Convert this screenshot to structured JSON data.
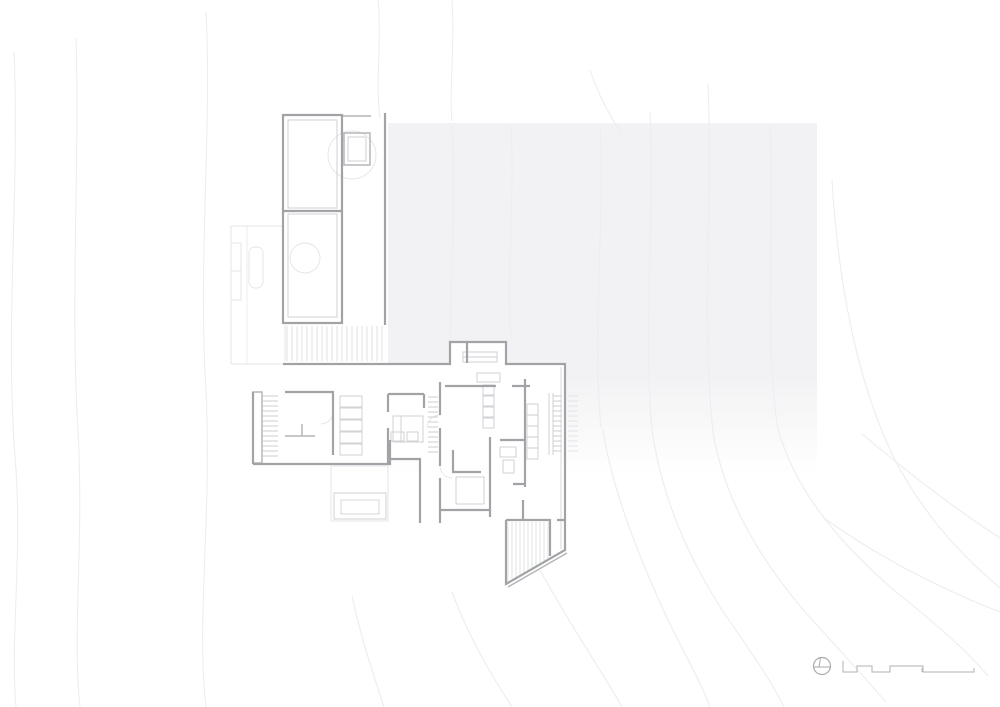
{
  "meta": {
    "canvas_width": 1000,
    "canvas_height": 707
  },
  "palette": {
    "background": "#ffffff",
    "wall": "#a2a3a6",
    "wall_light": "#b5b6b9",
    "detail": "#cdced1",
    "hatch": "#d8d9db",
    "faint": "#e3e4e7",
    "contour": "#ecedf0",
    "roof_shade": "#f2f2f4",
    "symbol": "#a8a9ab"
  },
  "symbols": {
    "north_arrow_icon": "circle with meridian chord",
    "scale_bar_icon": "stepped graphic scale"
  },
  "drawing": {
    "layers": [
      {
        "name": "roof-shade",
        "stroke": "none",
        "width": 0,
        "elements": [
          {
            "t": "rect",
            "x": 388,
            "y": 123,
            "w": 429,
            "h": 352,
            "fill": "url(#shadeGrad)",
            "sw": 0
          }
        ]
      },
      {
        "name": "contours",
        "stroke": "#ecedf0",
        "width": 1.1,
        "elements": [
          {
            "t": "path",
            "d": "M14 52 C20 190 4 330 16 470 C22 560 10 640 16 707"
          },
          {
            "t": "path",
            "d": "M76 38 C80 160 70 300 78 430 C84 550 72 630 80 707"
          },
          {
            "t": "path",
            "d": "M206 12 C212 130 198 260 206 390 C212 520 196 620 206 707"
          },
          {
            "t": "path",
            "d": "M378 0 C382 42 375 84 380 118"
          },
          {
            "t": "path",
            "d": "M452 0 C455 45 449 88 452 121"
          },
          {
            "t": "path",
            "d": "M590 70 C600 100 612 118 621 133"
          },
          {
            "t": "path",
            "d": "M452 126 C457 230 446 330 452 428"
          },
          {
            "t": "path",
            "d": "M511 126 C515 200 506 280 511 338"
          },
          {
            "t": "path",
            "d": "M600 126 C605 220 592 330 601 428"
          },
          {
            "t": "path",
            "d": "M603 430 C612 490 640 560 668 620 C685 655 700 680 710 707"
          },
          {
            "t": "path",
            "d": "M650 112 C655 220 643 330 652 430 C662 500 690 560 722 610 C748 648 770 678 784 707"
          },
          {
            "t": "path",
            "d": "M708 84 C713 200 701 320 713 432 C725 505 765 565 805 612 C838 648 865 678 886 702"
          },
          {
            "t": "path",
            "d": "M770 126 C775 230 764 330 777 424 C793 492 845 548 896 592 C934 622 968 652 988 676"
          },
          {
            "t": "path",
            "d": "M832 180 C838 280 856 380 894 458 C926 520 965 558 1000 588"
          },
          {
            "t": "path",
            "d": "M862 434 C912 476 960 512 1000 538"
          },
          {
            "t": "path",
            "d": "M824 518 C874 554 934 586 1000 612"
          },
          {
            "t": "path",
            "d": "M352 596 C362 642 374 676 384 707"
          },
          {
            "t": "path",
            "d": "M452 592 C470 640 492 676 512 707"
          },
          {
            "t": "path",
            "d": "M540 570 C570 625 600 668 622 707"
          }
        ]
      },
      {
        "name": "plan-fill",
        "stroke": "none",
        "width": 0,
        "elements": [
          {
            "t": "path",
            "d": "M283 364 H450 V342 H506 V364 H565 V550 L506 584 V520 H440 V523 H420 V459 H390 V464 H253 V392 H283 Z",
            "fill": "#ffffff",
            "sw": 0
          }
        ]
      },
      {
        "name": "faint",
        "stroke": "#e3e4e7",
        "width": 0.9,
        "elements": [
          {
            "t": "path",
            "d": "M231 364 V226 H283"
          },
          {
            "t": "path",
            "d": "M231 364 H283"
          },
          {
            "t": "path",
            "d": "M247 226 V364",
            "sw": 0.7
          },
          {
            "t": "rect",
            "x": 231,
            "y": 243,
            "w": 10,
            "h": 28
          },
          {
            "t": "rect",
            "x": 231,
            "y": 271,
            "w": 10,
            "h": 29
          },
          {
            "t": "rect",
            "x": 249,
            "y": 247,
            "w": 14,
            "h": 41,
            "rx": 6
          },
          {
            "t": "circle",
            "cx": 352,
            "cy": 155,
            "r": 24
          },
          {
            "t": "circle",
            "cx": 305,
            "cy": 258,
            "r": 15
          },
          {
            "t": "rect",
            "x": 331,
            "y": 466,
            "w": 57,
            "h": 55
          },
          {
            "t": "path",
            "d": "M285 325 V361"
          },
          {
            "t": "hh",
            "x0": 568,
            "x1": 578,
            "y0": 396,
            "y1": 454,
            "step": 5
          },
          {
            "t": "path",
            "d": "M440 415 A13 13 0 0 0 427 428"
          },
          {
            "t": "path",
            "d": "M440 466 A12 12 0 0 0 452 478"
          },
          {
            "t": "path",
            "d": "M333 412 A12 12 0 0 1 321 424"
          }
        ]
      },
      {
        "name": "hatch",
        "stroke": "#d8d9db",
        "width": 0.8,
        "elements": [
          {
            "t": "hv",
            "x0": 287,
            "x1": 382,
            "y0": 326,
            "y1": 361,
            "step": 5
          },
          {
            "t": "path",
            "d": "M508 522 V582.8 M512 522 V580.5 M516 522 V578.2 M520 522 V575.9 M524 522 V573.6 M528 522 V571.3 M532 522 V569 M536 522 V566.7 M540 522 V564.4 M544 522 V562.1 M548 522 V559.8"
          }
        ]
      },
      {
        "name": "detail",
        "stroke": "#cdced1",
        "width": 0.9,
        "elements": [
          {
            "t": "rect",
            "x": 288,
            "y": 120,
            "w": 49,
            "h": 88
          },
          {
            "t": "rect",
            "x": 288,
            "y": 214,
            "w": 49,
            "h": 103
          },
          {
            "t": "rect",
            "x": 348,
            "y": 137,
            "w": 18,
            "h": 24
          },
          {
            "t": "rect",
            "x": 463,
            "y": 352,
            "w": 34,
            "h": 10
          },
          {
            "t": "line",
            "x1": 463,
            "y1": 357,
            "x2": 497,
            "y2": 357
          },
          {
            "t": "path",
            "d": "M549 393 V455 M553 393 V455"
          },
          {
            "t": "rect",
            "x": 340,
            "y": 396,
            "w": 22,
            "h": 11
          },
          {
            "t": "rect",
            "x": 340,
            "y": 408,
            "w": 22,
            "h": 11
          },
          {
            "t": "rect",
            "x": 340,
            "y": 420,
            "w": 22,
            "h": 11
          },
          {
            "t": "rect",
            "x": 340,
            "y": 432,
            "w": 22,
            "h": 11
          },
          {
            "t": "rect",
            "x": 340,
            "y": 444,
            "w": 22,
            "h": 11
          },
          {
            "t": "rect",
            "x": 393,
            "y": 416,
            "w": 30,
            "h": 26
          },
          {
            "t": "line",
            "x1": 401,
            "y1": 416,
            "x2": 401,
            "y2": 442
          },
          {
            "t": "rect",
            "x": 391,
            "y": 432,
            "w": 13,
            "h": 9
          },
          {
            "t": "rect",
            "x": 407,
            "y": 432,
            "w": 11,
            "h": 9
          },
          {
            "t": "rect",
            "x": 483,
            "y": 385,
            "w": 11,
            "h": 10
          },
          {
            "t": "rect",
            "x": 483,
            "y": 396,
            "w": 11,
            "h": 10
          },
          {
            "t": "rect",
            "x": 483,
            "y": 407,
            "w": 11,
            "h": 10
          },
          {
            "t": "rect",
            "x": 483,
            "y": 418,
            "w": 11,
            "h": 10
          },
          {
            "t": "rect",
            "x": 527,
            "y": 404,
            "w": 11,
            "h": 11
          },
          {
            "t": "rect",
            "x": 527,
            "y": 415,
            "w": 11,
            "h": 11
          },
          {
            "t": "rect",
            "x": 527,
            "y": 426,
            "w": 11,
            "h": 11
          },
          {
            "t": "rect",
            "x": 527,
            "y": 437,
            "w": 11,
            "h": 11
          },
          {
            "t": "rect",
            "x": 527,
            "y": 448,
            "w": 11,
            "h": 11
          },
          {
            "t": "rect",
            "x": 456,
            "y": 477,
            "w": 28,
            "h": 27
          },
          {
            "t": "rect",
            "x": 477,
            "y": 373,
            "w": 23,
            "h": 9
          },
          {
            "t": "rect",
            "x": 500,
            "y": 447,
            "w": 16,
            "h": 10
          },
          {
            "t": "rect",
            "x": 503,
            "y": 460,
            "w": 11,
            "h": 13
          },
          {
            "t": "path",
            "d": "M561 367 V549",
            "sw": 0.8
          },
          {
            "t": "rect",
            "x": 334,
            "y": 493,
            "w": 52,
            "h": 26
          },
          {
            "t": "rect",
            "x": 341,
            "y": 500,
            "w": 38,
            "h": 14,
            "sw": 0.8
          },
          {
            "t": "hh",
            "x0": 263,
            "x1": 278,
            "y0": 396,
            "y1": 456,
            "step": 5
          },
          {
            "t": "hh",
            "x0": 428,
            "x1": 438,
            "y0": 397,
            "y1": 453,
            "step": 5
          },
          {
            "t": "hh",
            "x0": 553,
            "x1": 562,
            "y0": 396,
            "y1": 454,
            "step": 5
          }
        ]
      },
      {
        "name": "walls-light",
        "stroke": "#b5b6b9",
        "width": 1.5,
        "elements": [
          {
            "t": "path",
            "d": "M342 116 H371"
          },
          {
            "t": "rect",
            "x": 253,
            "y": 392,
            "w": 9,
            "h": 71
          },
          {
            "t": "path",
            "d": "M285 436 H315 M302 424 V436"
          },
          {
            "t": "rect",
            "x": 344,
            "y": 133,
            "w": 26,
            "h": 32
          },
          {
            "t": "path",
            "d": "M567 553 L508 587"
          }
        ]
      },
      {
        "name": "walls",
        "stroke": "#a2a3a6",
        "width": 2.2,
        "elements": [
          {
            "t": "path",
            "d": "M283 115 H342 V323 H283 Z"
          },
          {
            "t": "line",
            "x1": 283,
            "y1": 211,
            "x2": 342,
            "y2": 211
          },
          {
            "t": "path",
            "d": "M385 113 V325"
          },
          {
            "t": "path",
            "d": "M283 364 H450 V342 H506 V364 H565 V550 L506 584 V520"
          },
          {
            "t": "path",
            "d": "M506 520 H550 V556"
          },
          {
            "t": "path",
            "d": "M253 464 H390 V459 H420 V523"
          },
          {
            "t": "path",
            "d": "M253 392 V464"
          },
          {
            "t": "path",
            "d": "M285 392 H333 V455"
          },
          {
            "t": "path",
            "d": "M388 394 H424"
          },
          {
            "t": "path",
            "d": "M388 394 V412 M388 428 V463"
          },
          {
            "t": "path",
            "d": "M424 394 V408"
          },
          {
            "t": "path",
            "d": "M390 440 V459"
          },
          {
            "t": "path",
            "d": "M440 382 V415 M440 428 V466 M440 478 V523"
          },
          {
            "t": "path",
            "d": "M445 386 H496 M512 386 H530"
          },
          {
            "t": "path",
            "d": "M490 437 V517"
          },
          {
            "t": "path",
            "d": "M441 510 H490"
          },
          {
            "t": "path",
            "d": "M453 450 V472 H481"
          },
          {
            "t": "path",
            "d": "M525 379 V487 M513 484 H525"
          },
          {
            "t": "path",
            "d": "M500 440 H525"
          },
          {
            "t": "path",
            "d": "M523 500 V520"
          },
          {
            "t": "path",
            "d": "M557 520 H565"
          },
          {
            "t": "path",
            "d": "M467 342 V363"
          }
        ]
      },
      {
        "name": "north-arrow",
        "stroke": "#a8a9ab",
        "width": 1.2,
        "elements": [
          {
            "t": "circle",
            "cx": 822,
            "cy": 666,
            "r": 8.5
          },
          {
            "t": "path",
            "d": "M813.5 667 H830.5",
            "sw": 1
          },
          {
            "t": "path",
            "d": "M820.5 657.8 L819 667",
            "sw": 1
          }
        ]
      },
      {
        "name": "scale-bar",
        "stroke": "#b0b1b3",
        "width": 1,
        "elements": [
          {
            "t": "path",
            "d": "M843 661 V672 H857 V666 H872 V672 H890 V666 H923 V672 H974 V668"
          },
          {
            "t": "path",
            "d": "M922 668 V672",
            "sw": 0.8
          }
        ]
      }
    ]
  }
}
